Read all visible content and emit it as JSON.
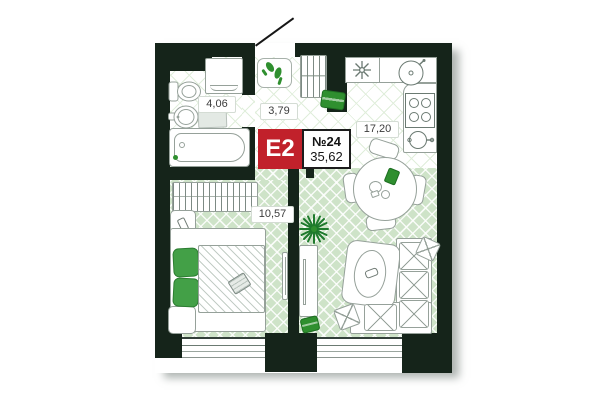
{
  "badge": {
    "unit_type": "E2",
    "apartment_number": "№24",
    "total_area": "35,62"
  },
  "rooms": {
    "bathroom": {
      "name": "bathroom",
      "area": "4,06"
    },
    "hallway": {
      "name": "hallway",
      "area": "3,79"
    },
    "kitchen_living": {
      "name": "kitchen-living-room",
      "area": "17,20"
    },
    "bedroom": {
      "name": "bedroom",
      "area": "10,57"
    }
  },
  "colors": {
    "wall": "#15241a",
    "floor_herringbone_green": "#cee3c8",
    "floor_tile_line": "#e0eedb",
    "accent_green": "#2f8f2f",
    "furniture_stroke": "#96a19a",
    "badge_red": "#c1212b"
  },
  "icons": {
    "entry-door-icon": "diagonal-open-door-leaf",
    "shoes-icon": "pair-of-green-heels",
    "coat-rack-icon": "hanger-rail-hatch",
    "doormat-icon": "green-mat",
    "toilet-icon": "tank-and-bowl",
    "bathroom-sink-icon": "oval-basin-with-tap",
    "washing-machine-icon": "square-front-loader",
    "bathtub-icon": "rounded-tub",
    "bath-mat-icon": "grey-mat",
    "kitchen-sink-icon": "round-bowl-with-tap",
    "hob-icon": "four-burners",
    "oven-icon": "dial-with-handle",
    "dining-table-icon": "round-table-four-chairs",
    "plant-icon": "starburst-leaves",
    "sofa-icon": "l-shaped-sofa-x-cushions",
    "tv-icon": "thin-wall-panel",
    "bed-icon": "double-bed-hatched-blanket",
    "pillow-icon": "green-pillow",
    "wardrobe-icon": "hatched-closet",
    "nightstand-icon": "small-square-table",
    "window-icon": "double-line-frame"
  }
}
